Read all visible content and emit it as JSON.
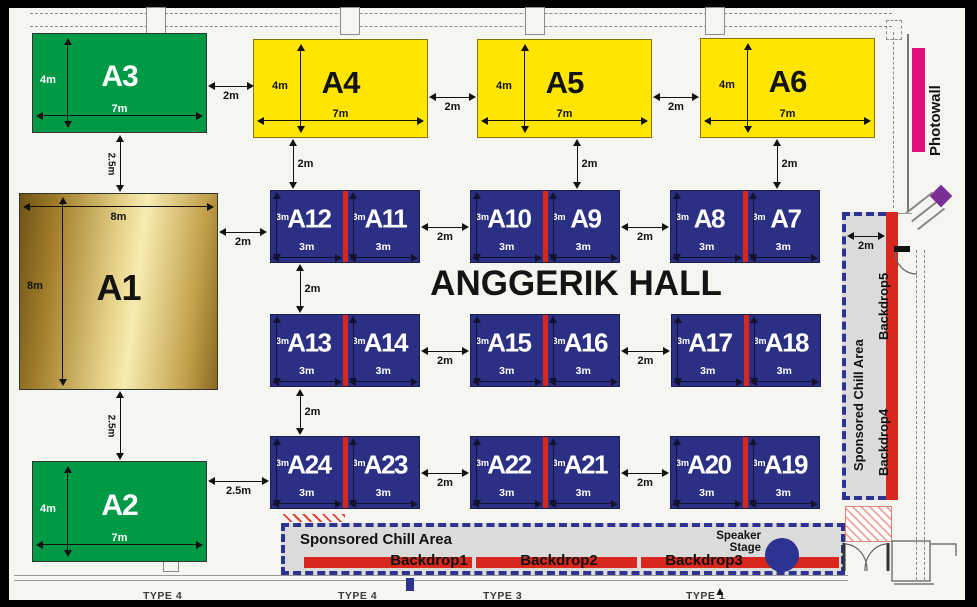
{
  "hall_title": "ANGGERIK HALL",
  "booths": {
    "big": [
      {
        "name": "A3",
        "width": "7m",
        "height": "4m"
      },
      {
        "name": "A4",
        "width": "7m",
        "height": "4m"
      },
      {
        "name": "A5",
        "width": "7m",
        "height": "4m"
      },
      {
        "name": "A6",
        "width": "7m",
        "height": "4m"
      },
      {
        "name": "A1",
        "width": "8m",
        "height": "8m"
      },
      {
        "name": "A2",
        "width": "7m",
        "height": "4m"
      }
    ],
    "pairs": [
      {
        "left": "A12",
        "right": "A11"
      },
      {
        "left": "A10",
        "right": "A9"
      },
      {
        "left": "A8",
        "right": "A7"
      },
      {
        "left": "A13",
        "right": "A14"
      },
      {
        "left": "A15",
        "right": "A16"
      },
      {
        "left": "A17",
        "right": "A18"
      },
      {
        "left": "A24",
        "right": "A23"
      },
      {
        "left": "A22",
        "right": "A21"
      },
      {
        "left": "A20",
        "right": "A19"
      }
    ],
    "pair_dim": "3m"
  },
  "gaps": {
    "a3_a4": "2m",
    "a4_a5": "2m",
    "a5_a6": "2m",
    "a1_a12": "2m",
    "a2_a24": "2.5m",
    "a3_a1": "2.5m",
    "a1_a2": "2.5m",
    "col1_top": "2m",
    "col2_top": "2m",
    "col3_top": "2m",
    "r1_gap1": "2m",
    "r1_gap2": "2m",
    "r2_gap1": "2m",
    "r2_gap2": "2m",
    "r3_gap1": "2m",
    "r3_gap2": "2m",
    "rows_12": "2m",
    "rows_23": "2m",
    "chill_right_gap": "2m"
  },
  "chill_bottom": {
    "label": "Sponsored Chill Area",
    "backdrops": [
      "Backdrop1",
      "Backdrop2",
      "Backdrop3"
    ],
    "speaker_label": "Speaker Stage"
  },
  "chill_right": {
    "label": "Sponsored Chill Area",
    "backdrops": [
      "Backdrop4",
      "Backdrop5"
    ]
  },
  "photowall_label": "Photowall",
  "floor_labels": [
    "TYPE 4",
    "TYPE 4",
    "TYPE 3",
    "TYPE 1"
  ],
  "colors": {
    "booth_green": "#009a47",
    "booth_yellow": "#ffe500",
    "booth_navy": "#2b3084",
    "divider_red": "#d8281e",
    "gold_dark": "#6f5316",
    "gold_light": "#f6ecb0",
    "chill_grey": "#dbdbd9",
    "dash_blue": "#2c3390",
    "photowall_pink": "#e0117f",
    "door_purple": "#7b2f96"
  }
}
